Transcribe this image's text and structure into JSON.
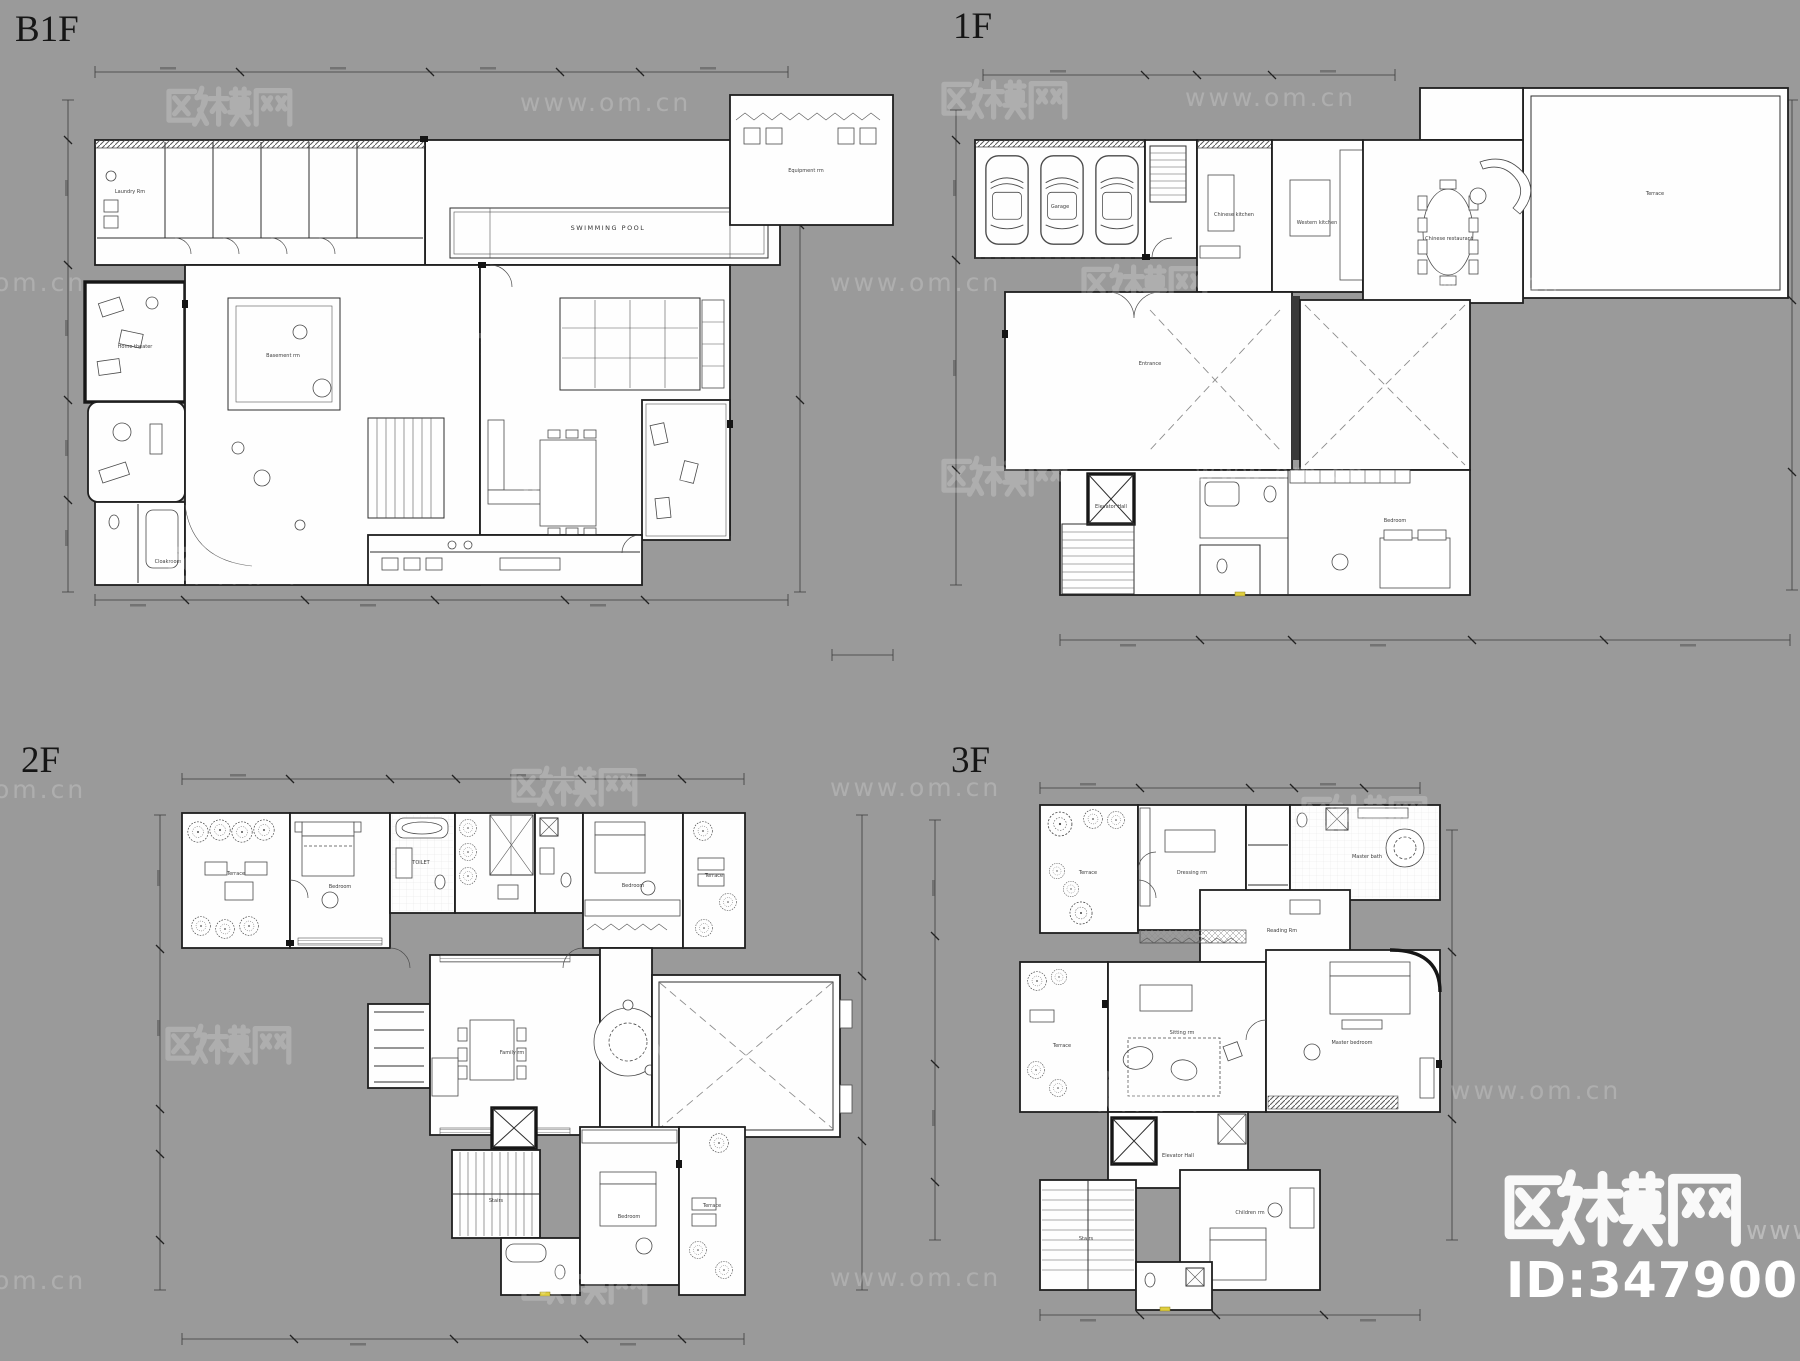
{
  "page": {
    "background": "#9a9a9a",
    "plan_fill": "#fefefe",
    "line_color": "#1f1f1f",
    "accent_yellow": "#e0cf3f"
  },
  "floors": [
    {
      "name": "B1F",
      "rooms": [
        "Laundry Rm",
        "Basement rm",
        "SWIMMING POOL",
        "Equipment rm",
        "Cloakroom",
        "Home theater"
      ]
    },
    {
      "name": "1F",
      "rooms": [
        "Garage",
        "Chinese kitchen",
        "Western kitchen",
        "Chinese restaurant",
        "Entrance",
        "Elevator Hall",
        "Bedroom",
        "Terrace"
      ]
    },
    {
      "name": "2F",
      "rooms": [
        "Terrace",
        "Bedroom",
        "TOILET",
        "Bedroom",
        "Terrace",
        "Family rm",
        "Stairs",
        "Bedroom",
        "Terrace"
      ]
    },
    {
      "name": "3F",
      "rooms": [
        "Terrace",
        "Dressing rm",
        "Master bath",
        "Reading Rm",
        "Terrace",
        "Sitting rm",
        "Master bedroom",
        "Elevator Hall",
        "Stairs",
        "Children rm"
      ]
    }
  ],
  "watermark": {
    "brand": "欧模网",
    "site": "www.om.cn",
    "www_partial": "www.",
    "id_text": "ID:3479003",
    "tiles": [
      {
        "x": 165,
        "y": 85,
        "t": "b"
      },
      {
        "x": 520,
        "y": 88,
        "t": "u"
      },
      {
        "x": 940,
        "y": 78,
        "t": "b"
      },
      {
        "x": 1185,
        "y": 83,
        "t": "u"
      },
      {
        "x": -85,
        "y": 268,
        "t": "u"
      },
      {
        "x": 385,
        "y": 330,
        "t": "b"
      },
      {
        "x": 830,
        "y": 268,
        "t": "u"
      },
      {
        "x": 1080,
        "y": 263,
        "t": "b"
      },
      {
        "x": 1390,
        "y": 268,
        "t": "u"
      },
      {
        "x": 167,
        "y": 543,
        "t": "b"
      },
      {
        "x": 520,
        "y": 470,
        "t": "u"
      },
      {
        "x": 940,
        "y": 455,
        "t": "b"
      },
      {
        "x": 1195,
        "y": 458,
        "t": "u"
      },
      {
        "x": -85,
        "y": 775,
        "t": "u"
      },
      {
        "x": 510,
        "y": 765,
        "t": "b"
      },
      {
        "x": 830,
        "y": 773,
        "t": "u"
      },
      {
        "x": 1300,
        "y": 793,
        "t": "b"
      },
      {
        "x": 164,
        "y": 1023,
        "t": "b"
      },
      {
        "x": 608,
        "y": 1033,
        "t": "u"
      },
      {
        "x": 1070,
        "y": 1070,
        "t": "b"
      },
      {
        "x": 1450,
        "y": 1076,
        "t": "u"
      },
      {
        "x": 520,
        "y": 1263,
        "t": "b"
      },
      {
        "x": -85,
        "y": 1266,
        "t": "u"
      },
      {
        "x": 830,
        "y": 1263,
        "t": "u"
      }
    ]
  }
}
